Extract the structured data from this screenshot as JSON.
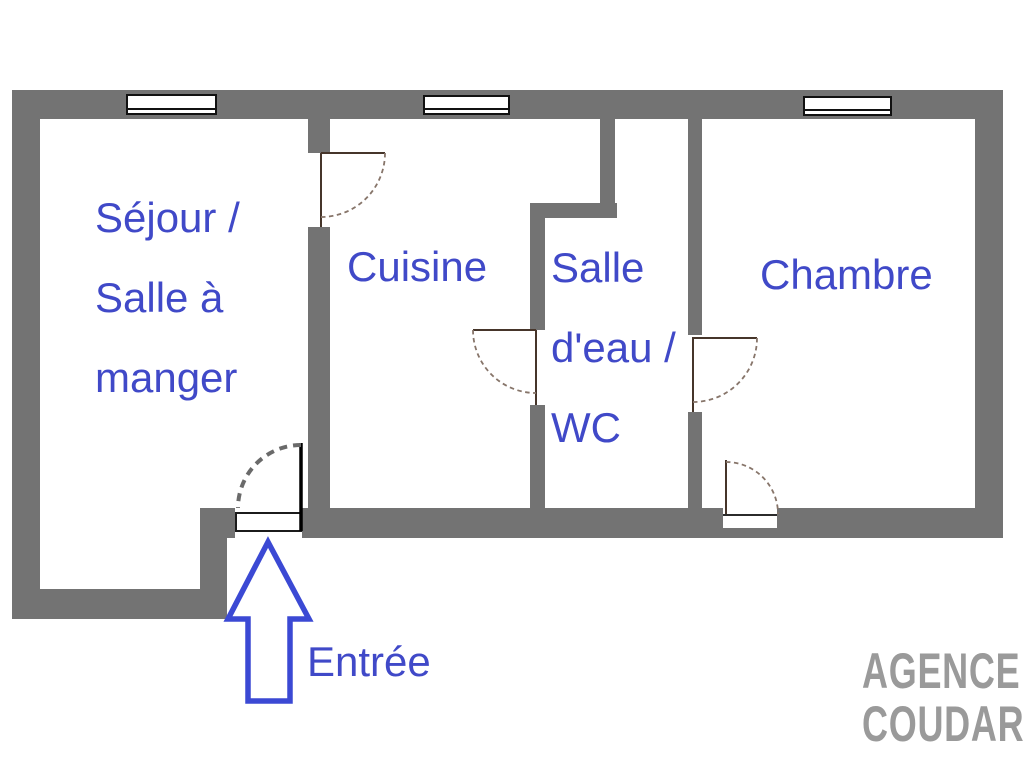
{
  "plan": {
    "type": "apartment-floor-plan",
    "rooms": {
      "sejour": {
        "lines": [
          "Séjour /",
          "Salle à",
          "manger"
        ]
      },
      "cuisine": {
        "label": "Cuisine"
      },
      "salle_deau": {
        "lines": [
          "Salle",
          "d'eau /",
          "WC"
        ]
      },
      "chambre": {
        "label": "Chambre"
      }
    },
    "entrance": {
      "label": "Entrée"
    },
    "watermark": {
      "lines": [
        "AGENCE",
        "COUDARI"
      ]
    },
    "colors": {
      "wall_gray": "#737373",
      "label_blue": "#4049c8",
      "arrow_blue": "#3b49d4",
      "watermark_gray": "#9a9a9a",
      "door_arc_brown": "#87756a",
      "door_frame_dark": "#46352a",
      "entrance_arc_gray": "#6a6a6a",
      "background": "#ffffff"
    }
  }
}
